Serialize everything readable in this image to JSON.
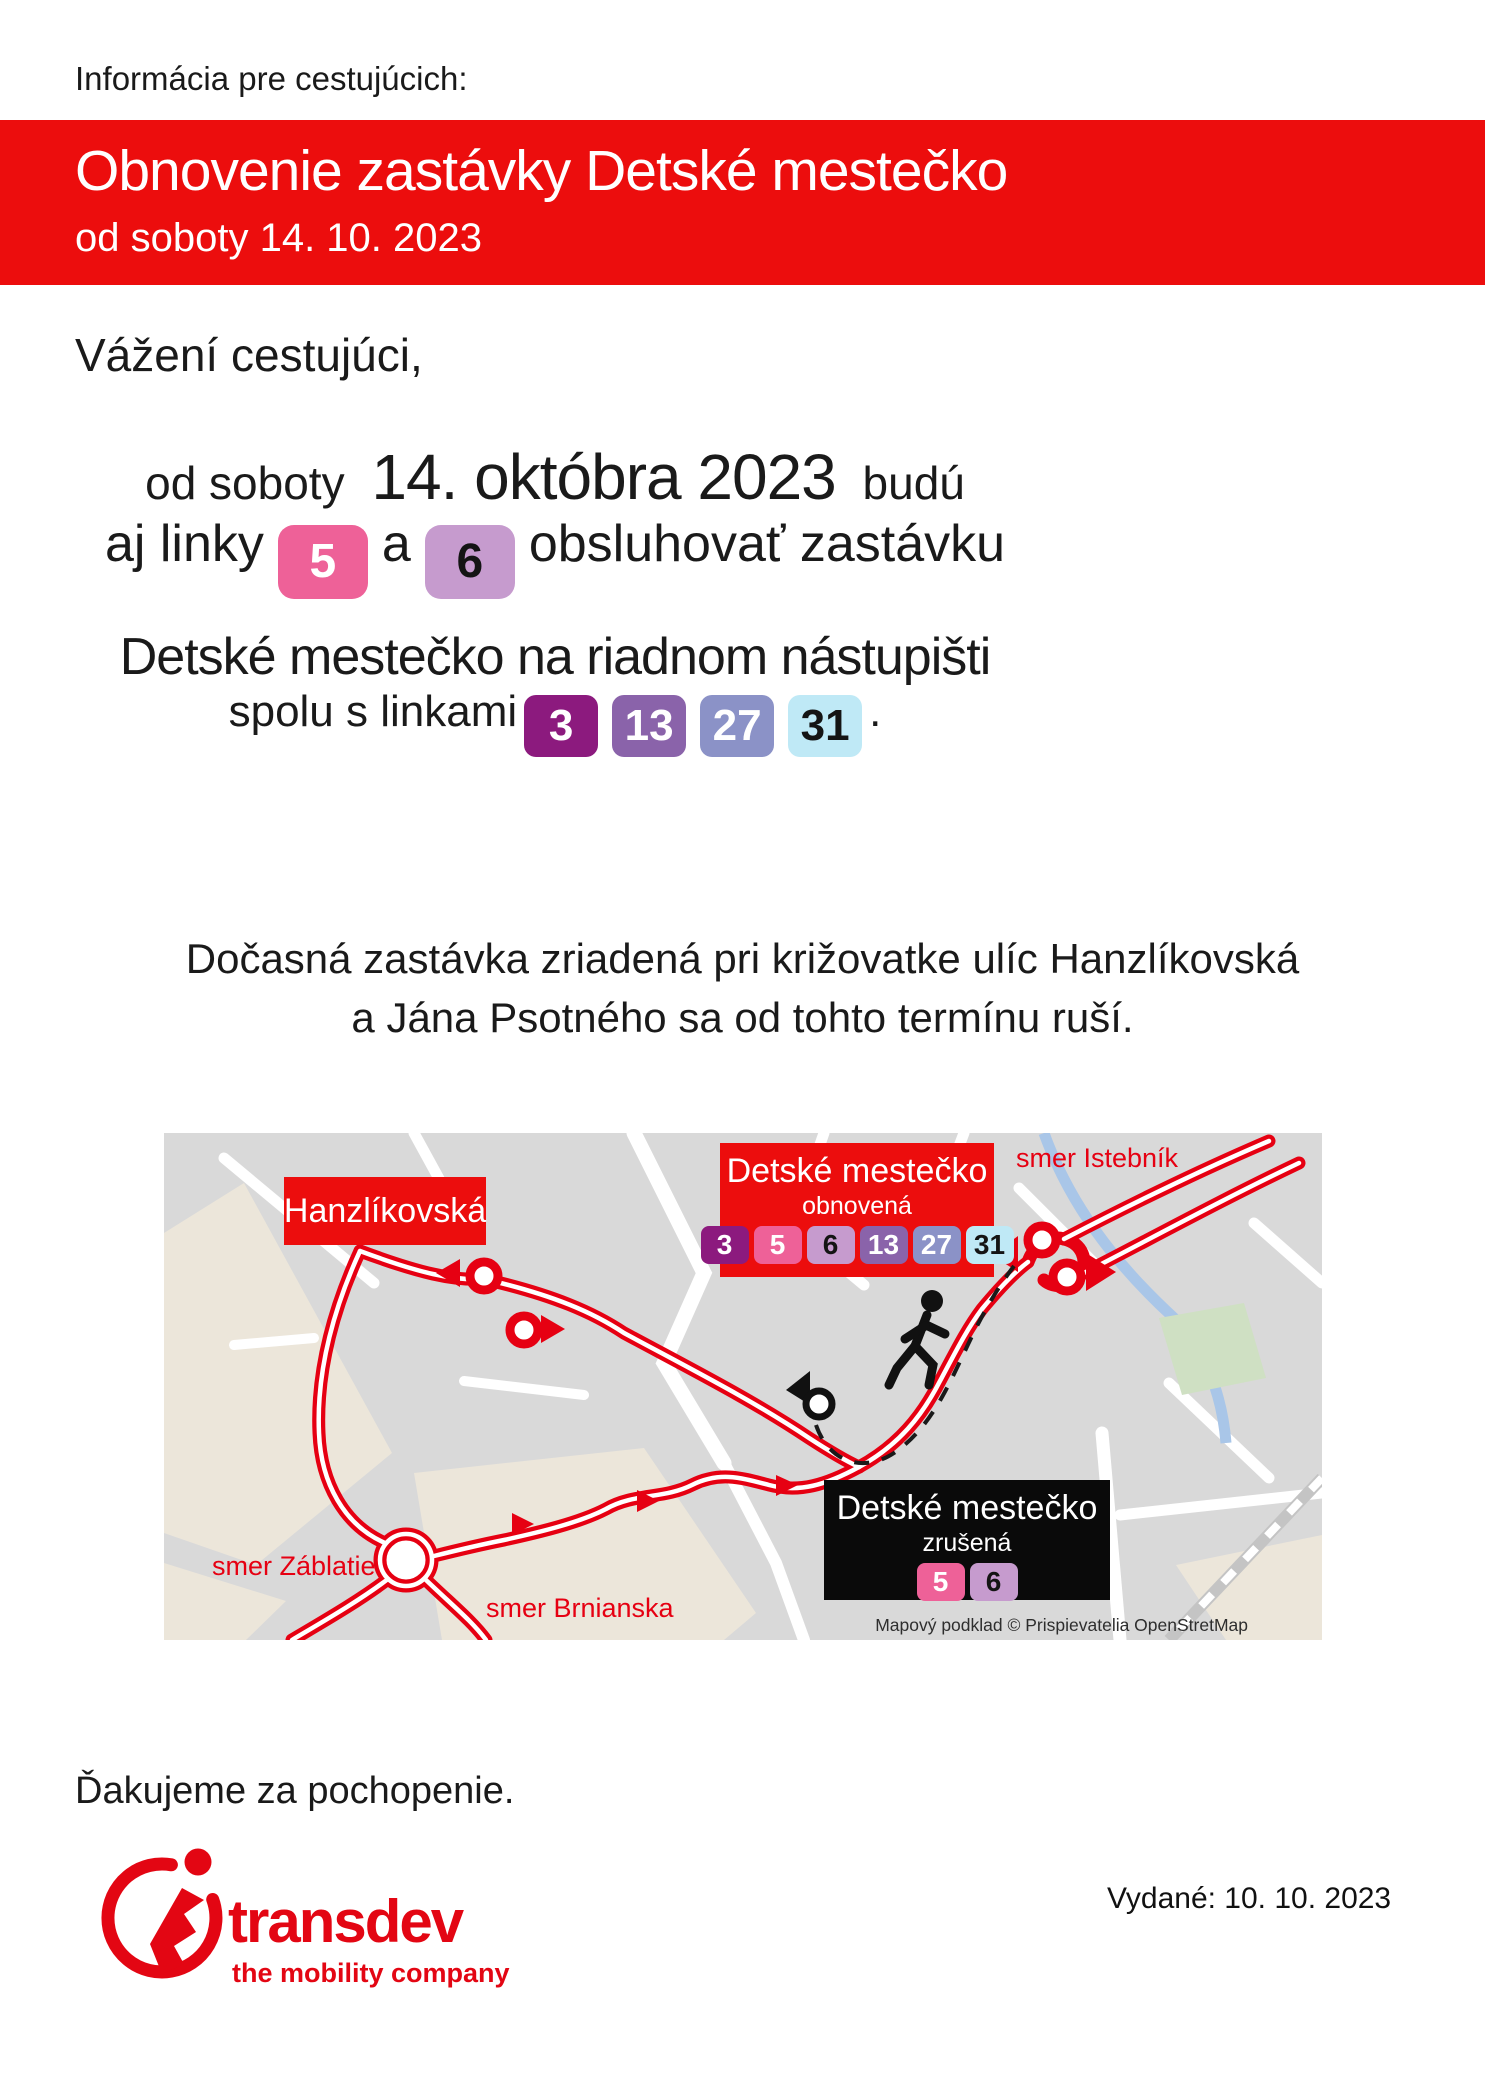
{
  "poster": {
    "info_label": "Informácia pre cestujúcich:",
    "thanks": "Ďakujeme za pochopenie.",
    "issued": "Vydané: 10. 10. 2023"
  },
  "banner": {
    "title": "Obnovenie zastávky Detské mestečko",
    "subtitle": "od soboty 14. 10. 2023",
    "bg_color": "#ec0d0d",
    "text_color": "#ffffff"
  },
  "body": {
    "salutation": "Vážení cestujúci,",
    "line1_pre": "od soboty",
    "line1_date": "14. októbra 2023",
    "line1_post": "budú",
    "line2_pre": "aj linky",
    "line2_conj": "a",
    "line2_post": "obsluhovať zastávku",
    "line2_badges_a": [
      "5"
    ],
    "line2_badges_b": [
      "6"
    ],
    "line3": "Detské mestečko na riadnom nástupišti",
    "line4_pre": "spolu s linkami",
    "line4_badges": [
      "3",
      "13",
      "27",
      "31"
    ],
    "line4_post": ".",
    "paragraph_line1": "Dočasná zastávka zriadená pri križovatke ulíc Hanzlíkovská",
    "paragraph_line2": "a Jána Psotného sa od tohto termínu ruší."
  },
  "lines": {
    "3": {
      "label": "3",
      "bg": "#8c1a7e",
      "fg": "#ffffff"
    },
    "5": {
      "label": "5",
      "bg": "#ee6198",
      "fg": "#ffffff"
    },
    "6": {
      "label": "6",
      "bg": "#c69bce",
      "fg": "#141414"
    },
    "13": {
      "label": "13",
      "bg": "#8a63aa",
      "fg": "#ffffff"
    },
    "27": {
      "label": "27",
      "bg": "#8b92c7",
      "fg": "#ffffff"
    },
    "31": {
      "label": "31",
      "bg": "#bfe9f6",
      "fg": "#141414"
    }
  },
  "map": {
    "street_label": "Hanzlíkovská",
    "direction_labels": {
      "istebnik": "smer Istebník",
      "zablatie": "smer Záblatie",
      "brnianska": "smer Brnianska"
    },
    "stop_restored": {
      "title": "Detské mestečko",
      "status": "obnovená",
      "lines": [
        "3",
        "5",
        "6",
        "13",
        "27",
        "31"
      ]
    },
    "stop_cancelled": {
      "title": "Detské mestečko",
      "status": "zrušená",
      "lines": [
        "5",
        "6"
      ]
    },
    "attribution": "Mapový podklad © Prispievatelia OpenStretMap",
    "colors": {
      "route": "#e60012",
      "background": "#d9d9d9",
      "roads": "#ffffff",
      "land": "#ece6da",
      "water": "#a9c6e8",
      "park": "#cfe0c3"
    }
  },
  "logo": {
    "brand": "transdev",
    "tagline": "the mobility company",
    "color": "#e30613"
  }
}
